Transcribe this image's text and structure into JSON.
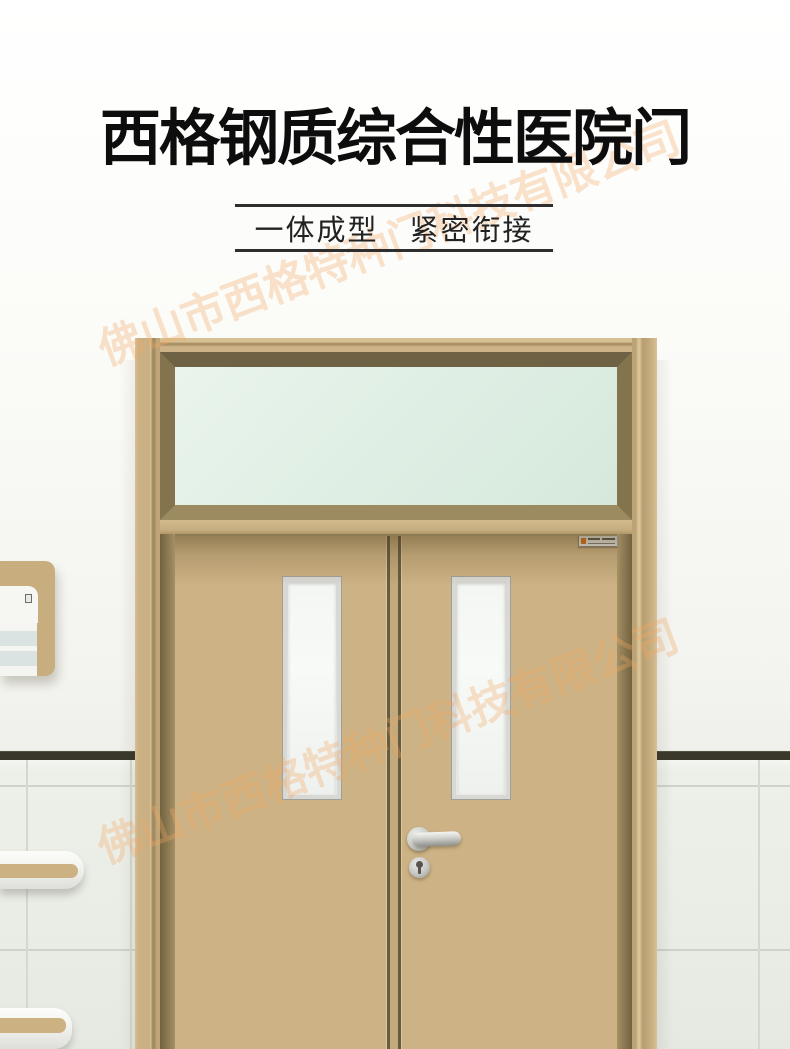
{
  "header": {
    "title": "西格钢质综合性医院门",
    "subtitle": "一体成型　紧密衔接"
  },
  "watermark": {
    "text": "佛山市西格特种门科技有限公司",
    "color": "#f2a762"
  },
  "palette": {
    "door_tan": "#ccb284",
    "frame_tan": "#c8ae81",
    "frame_bevel_olive": "#84744e",
    "transom_glass_green": "#e2f0e6",
    "vision_glass_white": "#f6f8f6",
    "hardware_silver": "#c9c9c6",
    "dado_rail_dark": "#3a372b",
    "tile_white": "#edf0e9",
    "wall_white": "#f8f8f5",
    "handrail_stripe_tan": "#ccb183",
    "plate_accent_orange": "#e07818",
    "title_black": "#0d0d0d"
  }
}
